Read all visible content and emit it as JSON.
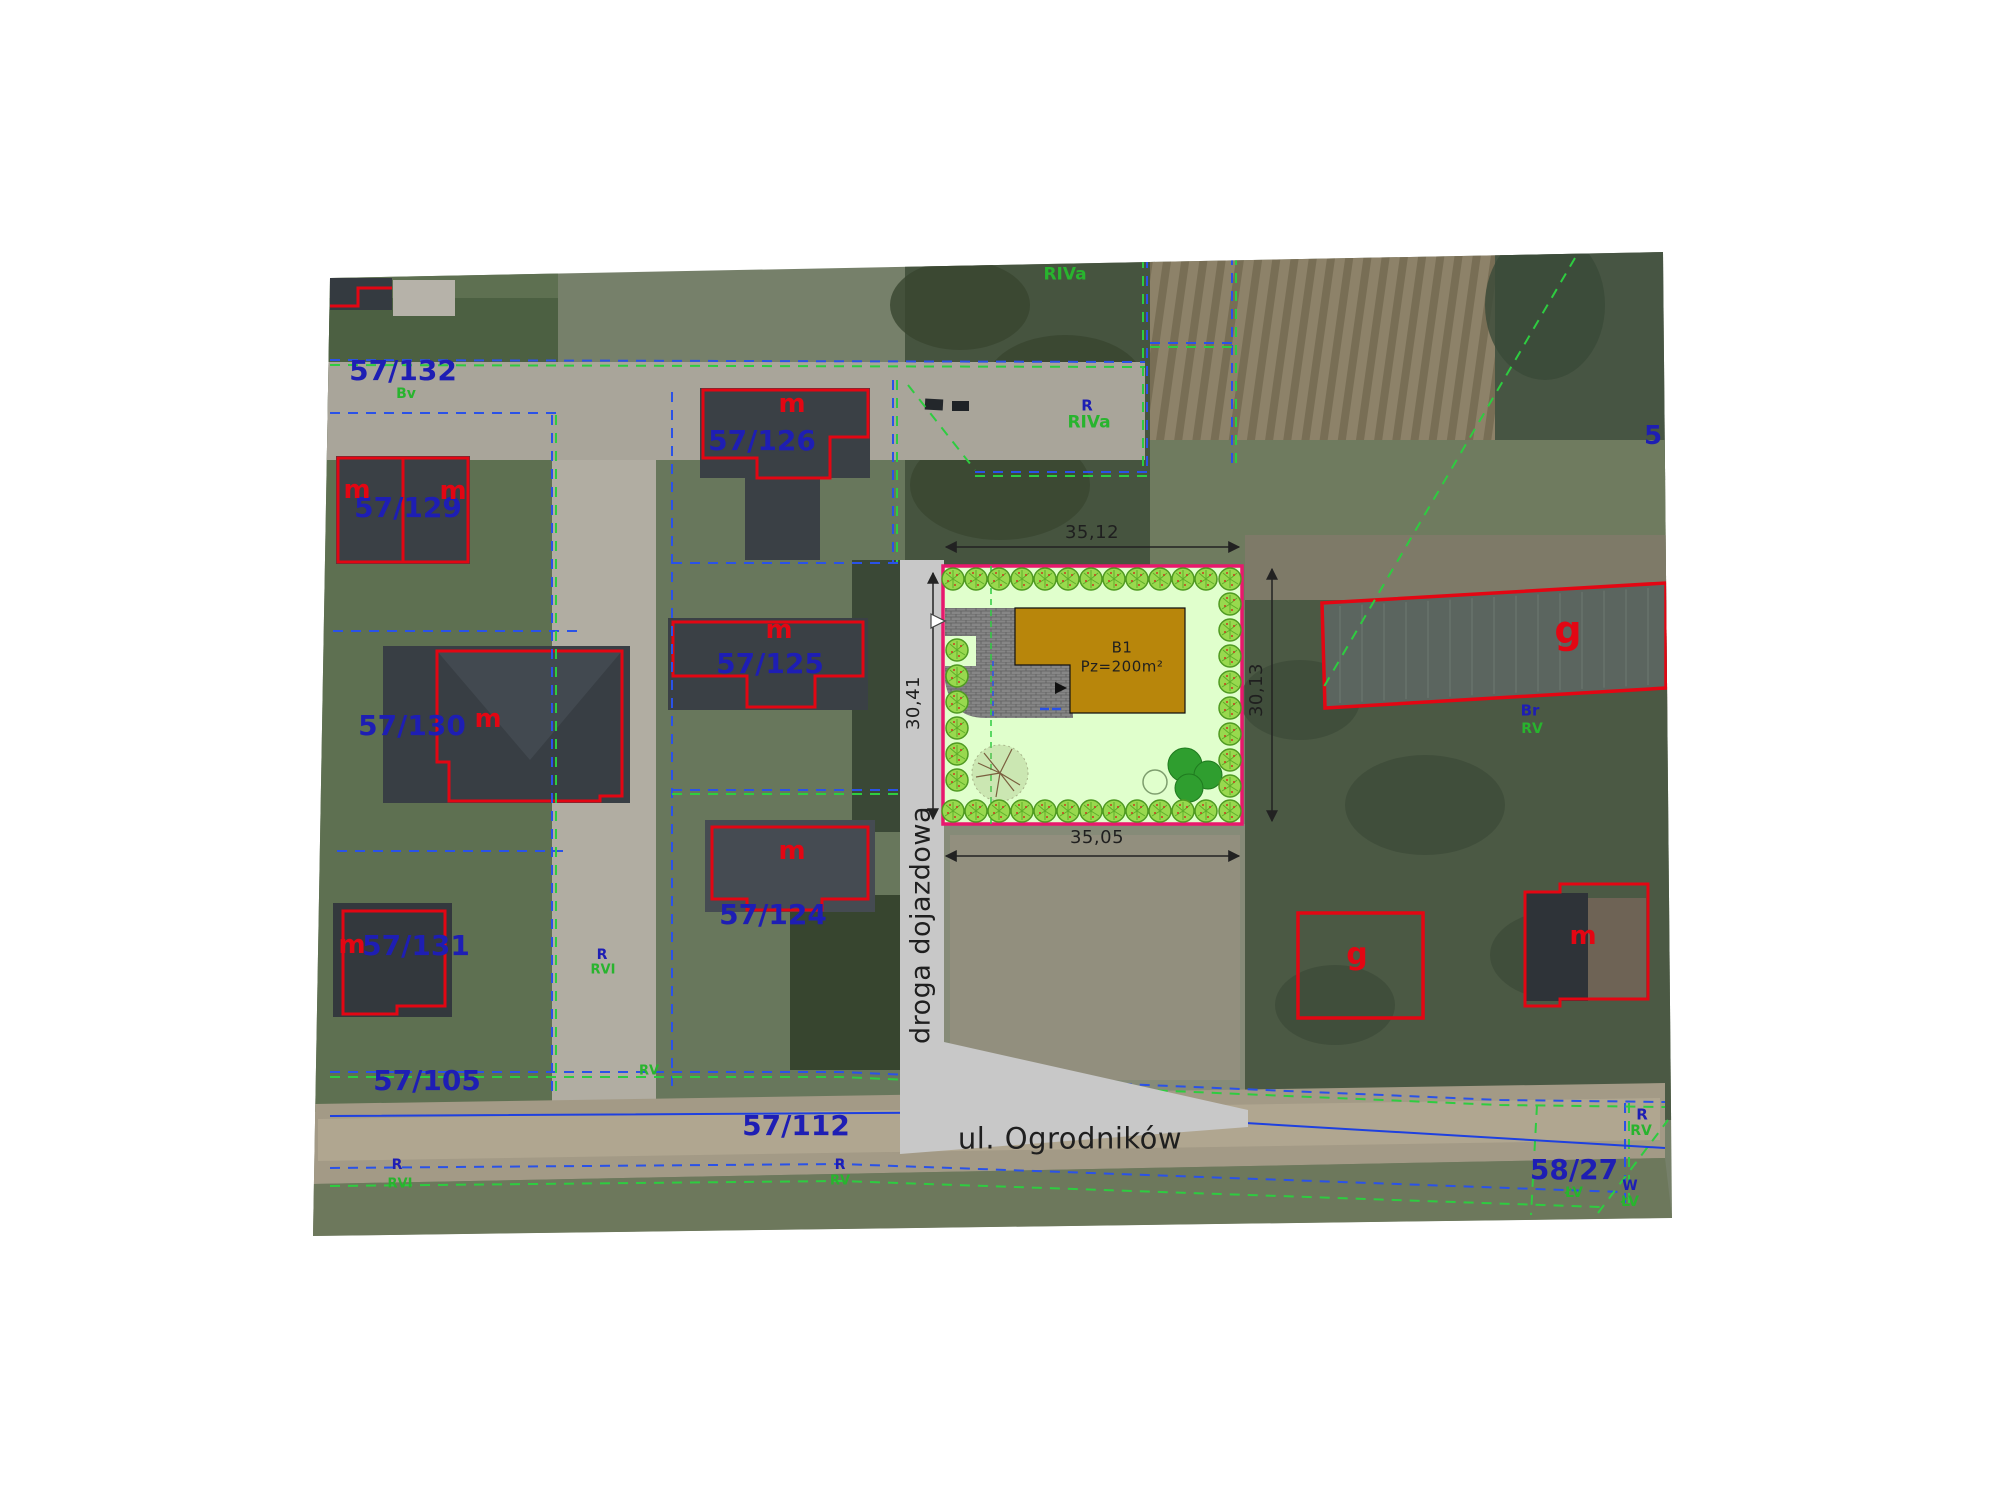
{
  "map_type": "cadastral site plan over aerial photo",
  "site_plan": {
    "building_id": "B1",
    "building_area": "Pz=200m²",
    "dim_top": "35,12",
    "dim_bottom": "35,05",
    "dim_right": "30,13",
    "dim_left": "30,41",
    "access_road": "droga dojazdowa",
    "street": "ul. Ogrodników"
  },
  "parcels": [
    "57/132",
    "57/129",
    "57/126",
    "57/125",
    "57/130",
    "57/124",
    "57/131",
    "57/105",
    "57/112",
    "58/27"
  ],
  "land_use_codes": [
    "RIVa",
    "RV",
    "RVI",
    "Bv",
    "Br",
    "ŁV",
    "W",
    "R",
    "g",
    "m"
  ],
  "colors": {
    "blue": "#1e1eb4",
    "green": "#28b42e",
    "red": "#e30613",
    "black": "#1f1f1f",
    "plot_border": "#e8186d",
    "building_fill": "#b8860b",
    "plot_lawn": "#e0ffcc",
    "access_road_fill": "#c8c8c8"
  },
  "labels": [
    {
      "name": "parcel-57-132",
      "text": "57/132",
      "x": 403,
      "y": 371,
      "color": "blue",
      "size": 28
    },
    {
      "name": "landuse-bv",
      "text": "Bv",
      "x": 406,
      "y": 394,
      "color": "green",
      "size": 14
    },
    {
      "name": "parcel-57-129",
      "text": "57/129",
      "x": 408,
      "y": 508,
      "color": "blue",
      "size": 28
    },
    {
      "name": "mark-m-129a",
      "text": "m",
      "x": 357,
      "y": 490,
      "color": "red",
      "size": 26
    },
    {
      "name": "mark-m-129b",
      "text": "m",
      "x": 453,
      "y": 491,
      "color": "red",
      "size": 26
    },
    {
      "name": "parcel-57-126",
      "text": "57/126",
      "x": 762,
      "y": 441,
      "color": "blue",
      "size": 28
    },
    {
      "name": "mark-m-126",
      "text": "m",
      "x": 792,
      "y": 404,
      "color": "red",
      "size": 26
    },
    {
      "name": "parcel-57-125",
      "text": "57/125",
      "x": 770,
      "y": 664,
      "color": "blue",
      "size": 28
    },
    {
      "name": "mark-m-125",
      "text": "m",
      "x": 779,
      "y": 630,
      "color": "red",
      "size": 26
    },
    {
      "name": "parcel-57-124",
      "text": "57/124",
      "x": 773,
      "y": 915,
      "color": "blue",
      "size": 28
    },
    {
      "name": "mark-m-124",
      "text": "m",
      "x": 792,
      "y": 851,
      "color": "red",
      "size": 26
    },
    {
      "name": "parcel-57-130",
      "text": "57/130",
      "x": 412,
      "y": 726,
      "color": "blue",
      "size": 28
    },
    {
      "name": "mark-m-130",
      "text": "m",
      "x": 488,
      "y": 719,
      "color": "red",
      "size": 26
    },
    {
      "name": "parcel-57-131",
      "text": "57/131",
      "x": 416,
      "y": 946,
      "color": "blue",
      "size": 28
    },
    {
      "name": "mark-m-131",
      "text": "m",
      "x": 352,
      "y": 945,
      "color": "red",
      "size": 26
    },
    {
      "name": "parcel-57-105",
      "text": "57/105",
      "x": 427,
      "y": 1081,
      "color": "blue",
      "size": 28
    },
    {
      "name": "parcel-57-112",
      "text": "57/112",
      "x": 796,
      "y": 1126,
      "color": "blue",
      "size": 28
    },
    {
      "name": "street-name",
      "text": "ul. Ogrodników",
      "x": 1070,
      "y": 1139,
      "color": "black",
      "size": 29
    },
    {
      "name": "parcel-58-27",
      "text": "58/27",
      "x": 1574,
      "y": 1170,
      "color": "blue",
      "size": 28
    },
    {
      "name": "landuse-lv-1",
      "text": "ŁV",
      "x": 1574,
      "y": 1193,
      "color": "green",
      "size": 14
    },
    {
      "name": "landuse-w",
      "text": "W",
      "x": 1630,
      "y": 1186,
      "color": "blue",
      "size": 14
    },
    {
      "name": "landuse-lv-2",
      "text": "ŁV",
      "x": 1630,
      "y": 1202,
      "color": "green",
      "size": 14
    },
    {
      "name": "landuse-r-1",
      "text": "R",
      "x": 1642,
      "y": 1115,
      "color": "blue",
      "size": 15
    },
    {
      "name": "landuse-rv-1",
      "text": "RV",
      "x": 1641,
      "y": 1131,
      "color": "green",
      "size": 14
    },
    {
      "name": "landuse-riva-top",
      "text": "RIVa",
      "x": 1065,
      "y": 275,
      "color": "green",
      "size": 17
    },
    {
      "name": "landuse-r-2",
      "text": "R",
      "x": 1087,
      "y": 406,
      "color": "blue",
      "size": 15
    },
    {
      "name": "landuse-riva-2",
      "text": "RIVa",
      "x": 1089,
      "y": 423,
      "color": "green",
      "size": 17
    },
    {
      "name": "landuse-br",
      "text": "Br",
      "x": 1530,
      "y": 711,
      "color": "blue",
      "size": 15
    },
    {
      "name": "landuse-rv-2",
      "text": "RV",
      "x": 1532,
      "y": 729,
      "color": "green",
      "size": 14
    },
    {
      "name": "mark-g-greenhouse",
      "text": "g",
      "x": 1568,
      "y": 630,
      "color": "red",
      "size": 38
    },
    {
      "name": "mark-g-plot",
      "text": "g",
      "x": 1357,
      "y": 955,
      "color": "red",
      "size": 30
    },
    {
      "name": "mark-m-farm",
      "text": "m",
      "x": 1583,
      "y": 936,
      "color": "red",
      "size": 26
    },
    {
      "name": "landuse-r-3",
      "text": "R",
      "x": 602,
      "y": 955,
      "color": "blue",
      "size": 14
    },
    {
      "name": "landuse-rvi-1",
      "text": "RVI",
      "x": 603,
      "y": 970,
      "color": "green",
      "size": 13
    },
    {
      "name": "landuse-rv-3",
      "text": "RV",
      "x": 649,
      "y": 1071,
      "color": "green",
      "size": 13
    },
    {
      "name": "landuse-r-4",
      "text": "R",
      "x": 840,
      "y": 1165,
      "color": "blue",
      "size": 14
    },
    {
      "name": "landuse-rv-4",
      "text": "RV",
      "x": 840,
      "y": 1181,
      "color": "green",
      "size": 13
    },
    {
      "name": "landuse-r-5",
      "text": "R",
      "x": 397,
      "y": 1165,
      "color": "blue",
      "size": 14
    },
    {
      "name": "landuse-rvi-2",
      "text": "RVI",
      "x": 400,
      "y": 1184,
      "color": "green",
      "size": 13
    },
    {
      "name": "parcel-5-partial",
      "text": "5",
      "x": 1653,
      "y": 436,
      "color": "blue",
      "size": 26
    },
    {
      "name": "building-id",
      "text": "B1",
      "x": 1122,
      "y": 648,
      "color": "black",
      "size": 15
    },
    {
      "name": "building-area",
      "text": "Pz=200m²",
      "x": 1122,
      "y": 667,
      "color": "black",
      "size": 15
    },
    {
      "name": "dim-top-label",
      "text": "35,12",
      "x": 1092,
      "y": 533,
      "color": "black",
      "size": 18
    },
    {
      "name": "dim-bottom-label",
      "text": "35,05",
      "x": 1097,
      "y": 838,
      "color": "black",
      "size": 18
    },
    {
      "name": "dim-right-label",
      "text": "30,13",
      "x": 1257,
      "y": 690,
      "color": "black",
      "size": 18,
      "rot": -90
    },
    {
      "name": "dim-left-label",
      "text": "30,41",
      "x": 914,
      "y": 703,
      "color": "black",
      "size": 18,
      "rot": -90
    },
    {
      "name": "access-road-label",
      "text": "droga dojazdowa",
      "x": 921,
      "y": 925,
      "color": "black",
      "size": 27,
      "rot": -90
    }
  ]
}
